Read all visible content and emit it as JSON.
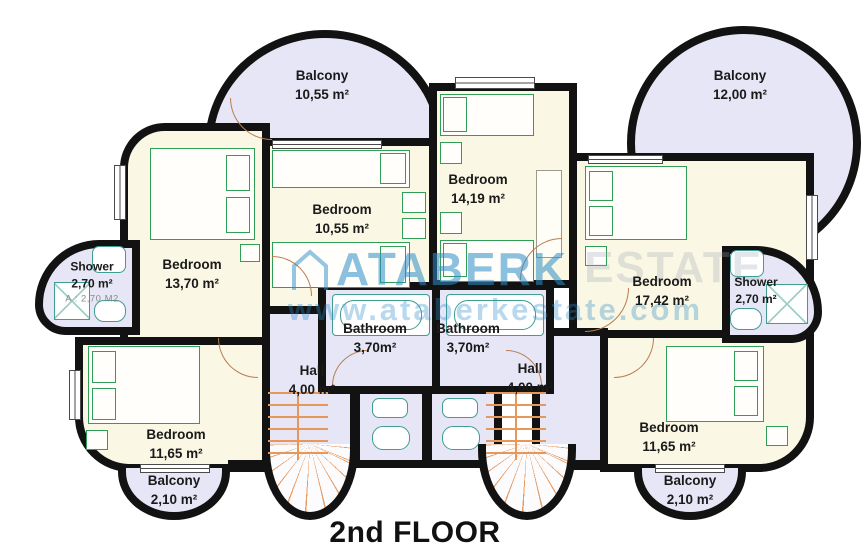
{
  "title": "2nd FLOOR",
  "watermark": {
    "brand": "ATABERK",
    "brand2": "ESTATE",
    "url": "www.ataberkestate.com",
    "icon": "house-outline-icon",
    "color": "#2b8dc9"
  },
  "rooms": {
    "balcony_top_left": {
      "label": "Balcony",
      "area": "10,55 m²"
    },
    "balcony_top_right": {
      "label": "Balcony",
      "area": "12,00 m²"
    },
    "bedroom_upper_left": {
      "label": "Bedroom",
      "area": "13,70 m²"
    },
    "bedroom_mid_left": {
      "label": "Bedroom",
      "area": "10,55 m²"
    },
    "bedroom_mid_right": {
      "label": "Bedroom",
      "area": "14,19 m²"
    },
    "bedroom_upper_right": {
      "label": "Bedroom",
      "area": "17,42 m²"
    },
    "shower_left": {
      "label": "Shower",
      "area": "2,70 m²",
      "note": "A : 2,70 M2"
    },
    "shower_right": {
      "label": "Shower",
      "area": "2,70 m²"
    },
    "bathroom_left": {
      "label": "Bathroom",
      "area": "3,70m²"
    },
    "bathroom_right": {
      "label": "Bathroom",
      "area": "3,70m²"
    },
    "hall_left": {
      "label": "Hall",
      "area": "4,00 m²"
    },
    "hall_right": {
      "label": "Hall",
      "area": "4,00 m²"
    },
    "bedroom_lower_left": {
      "label": "Bedroom",
      "area": "11,65 m²"
    },
    "bedroom_lower_right": {
      "label": "Bedroom",
      "area": "11,65 m²"
    },
    "balcony_bottom_left": {
      "label": "Balcony",
      "area": "2,10 m²"
    },
    "balcony_bottom_right": {
      "label": "Balcony",
      "area": "2,10 m²"
    }
  },
  "colors": {
    "wall": "#121212",
    "dry_room_floor": "#faf8e4",
    "wet_room_floor": "#e6e6f6",
    "furniture_outline": "#2f9e57",
    "fixture_outline": "#3f9d92",
    "stairs": "#e6975a",
    "watermark": "#2b8dc9"
  }
}
